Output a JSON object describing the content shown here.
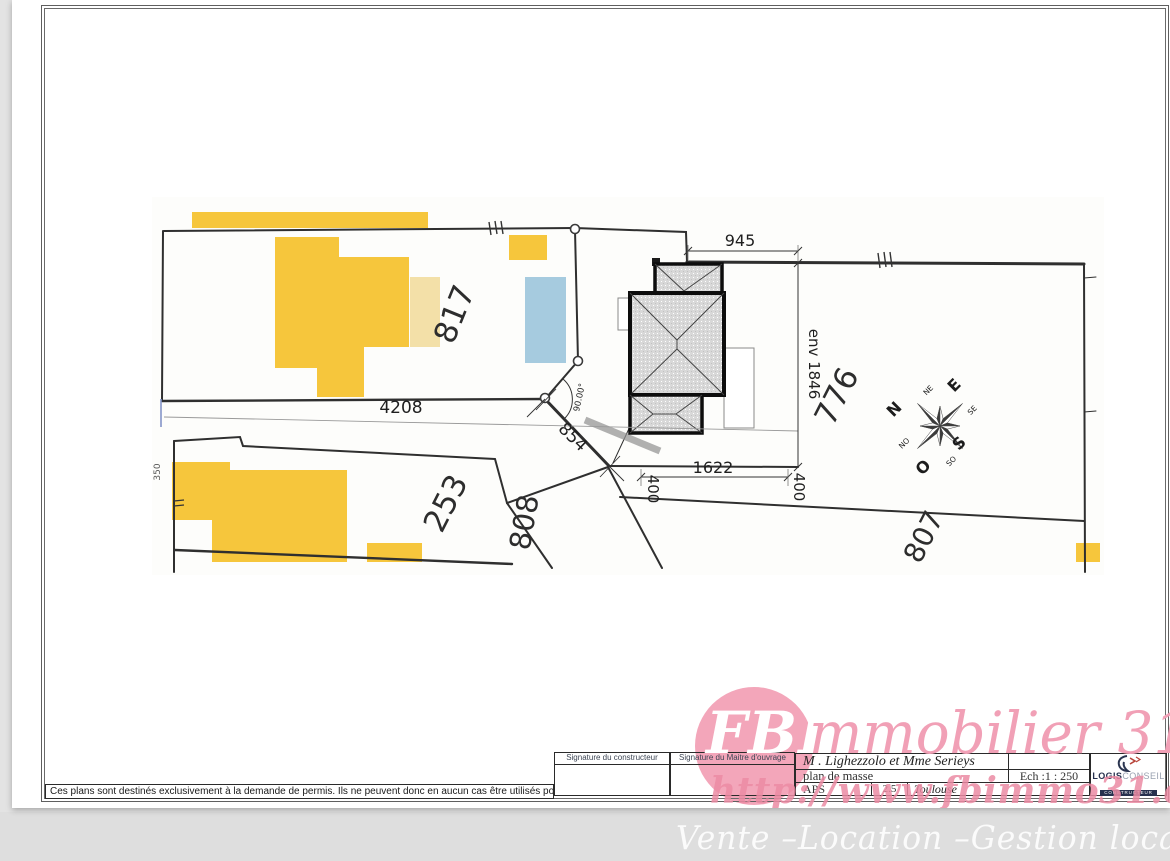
{
  "sheet": {
    "disclaimer": "Ces plans sont destinés exclusivement à la demande de permis. Ils ne peuvent donc en aucun cas être utilisés pour réaliser la construction"
  },
  "title_block": {
    "signature_left": "Signature du constructeur",
    "signature_right": "Signature du Maitre d'ouvrage",
    "client": "M . Lighezzolo et Mme Serieys",
    "doc_title": "plan de masse",
    "scale": "Ech :1 : 250",
    "phase": "APS",
    "revision": "2.5",
    "city": "Toulouse",
    "logo_bold": "LOGIS",
    "logo_light": "CONSEIL",
    "logo_sub": "CONSTRUCTEUR"
  },
  "watermark": {
    "brand_initials": "FBI",
    "brand_rest": "mmobilier 31",
    "url": "http://www.fbimmo31.com/",
    "services": "Vente –Location –Gestion locative",
    "pink": "#f1a0b6"
  },
  "plan": {
    "parcel_labels": {
      "p817": "817",
      "p776": "776",
      "p253": "253",
      "p808": "808",
      "p807": "807",
      "p350": "350"
    },
    "dims": {
      "top": "945",
      "right": "env 1846",
      "street": "4208",
      "diag": "854",
      "bottom": "1622",
      "offset_left": "400",
      "offset_right": "400",
      "angle": "90.00°"
    },
    "compass": {
      "n": "N",
      "e": "E",
      "s": "S",
      "o": "O",
      "ne": "NE",
      "se": "SE",
      "so": "SO",
      "no": "NO"
    },
    "colors": {
      "building": "#f6c63c",
      "annex": "#f3e0a8",
      "pool": "#a6cbdf",
      "roof": "#d8d8d8"
    }
  }
}
